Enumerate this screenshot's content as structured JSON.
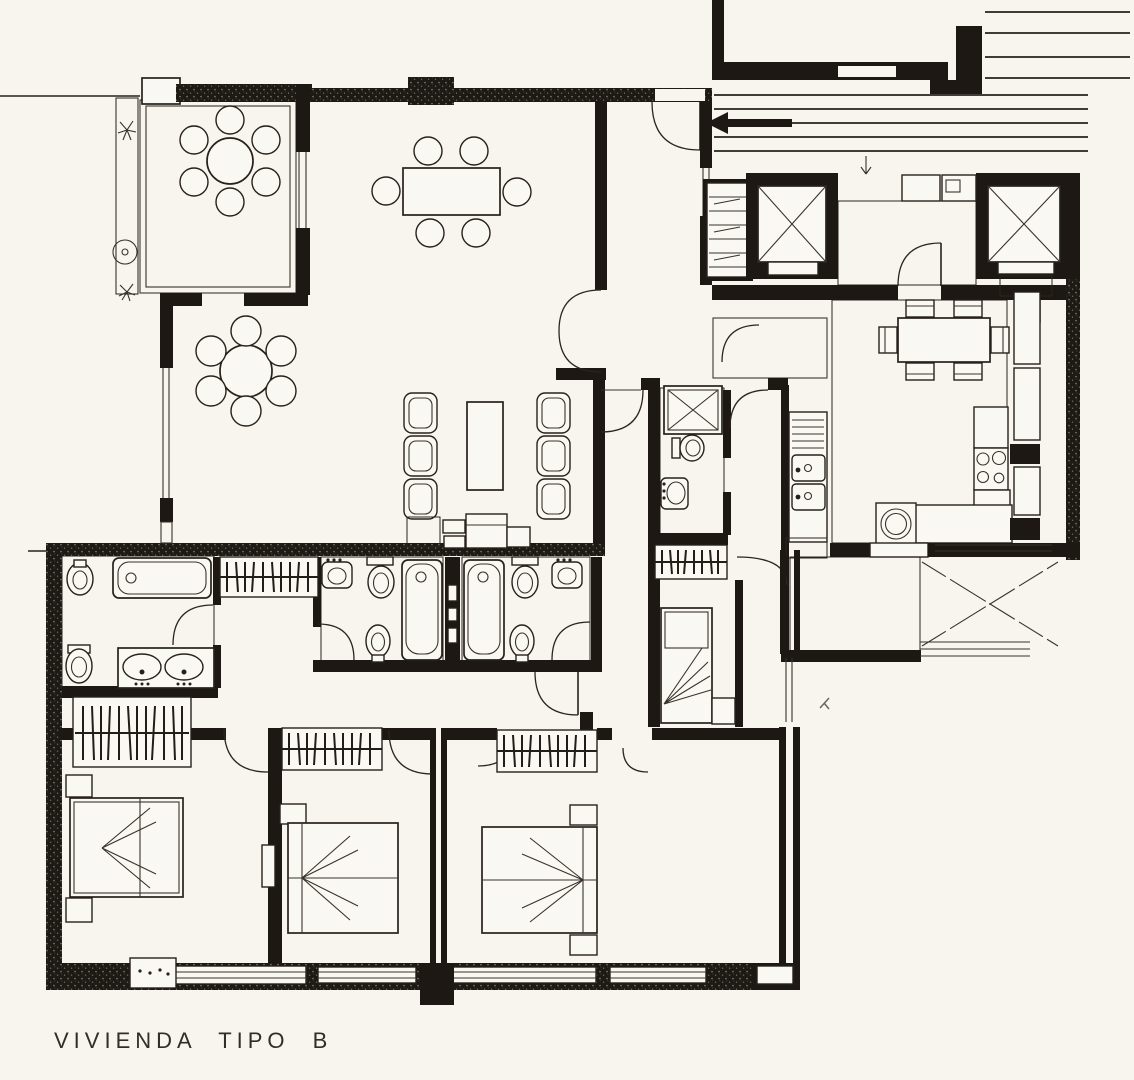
{
  "sheet": {
    "title": "VIVIENDA TIPO B",
    "colors": {
      "ink": "#1d1813",
      "paper": "#f7f5ee",
      "tile_line": "#575047"
    },
    "elements": [
      "terrace",
      "planter-plants",
      "round-terrace-table",
      "dining-table",
      "lounge-round-table",
      "sofa-armchairs",
      "coffee-table",
      "sideboard",
      "double-entry-door",
      "entry-gallery",
      "staircase",
      "direction-arrow",
      "elevator-left",
      "elevator-right",
      "elevator-lobby",
      "meter-closet",
      "kitchen",
      "kitchen-table",
      "kitchen-sink",
      "cooktop",
      "washer",
      "drying-terrace",
      "clothesline",
      "service-bathroom",
      "shower",
      "main-bathroom",
      "bathroom-2",
      "bathroom-3",
      "bathtub",
      "toilet",
      "bidet",
      "washbasin",
      "double-washbasin",
      "wardrobe-closets",
      "corridor",
      "bedroom-1",
      "bedroom-2",
      "bedroom-3",
      "service-bedroom",
      "double-bed",
      "single-bed",
      "nightstand",
      "dresser",
      "windows",
      "door-swings"
    ]
  }
}
